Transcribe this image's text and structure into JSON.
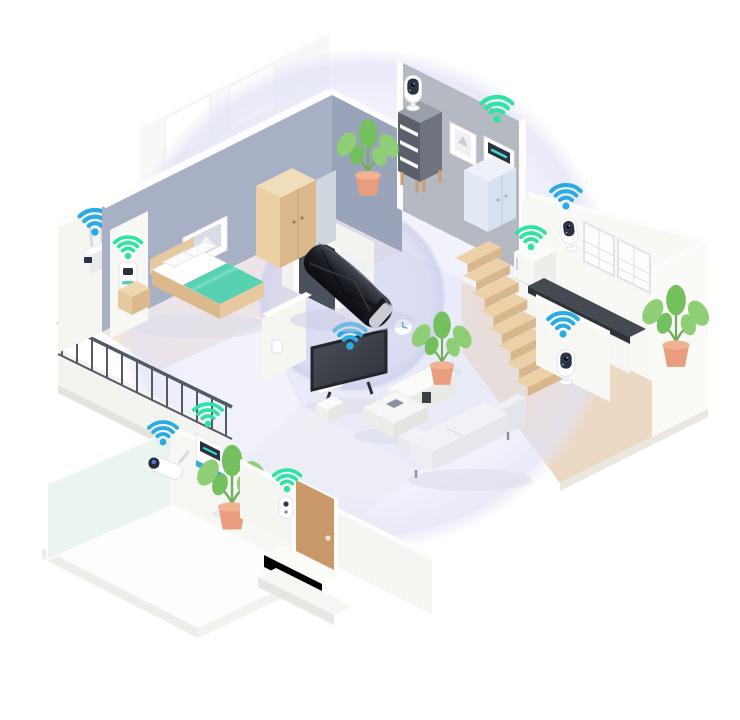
{
  "scene": {
    "type": "isometric-smart-home-wifi-coverage-illustration",
    "description": "Isometric cutaway of a two-level home. A black Wi-Fi router lies at the center of the living room surrounded by two lavender coverage circles. Teal-blue and spring-green Wi-Fi signal icons hover over connected smart devices in every room.",
    "rooms": [
      "bedroom",
      "living room",
      "kitchen",
      "entry hall",
      "balcony",
      "terrace"
    ],
    "coverage": {
      "outer_circle": true,
      "inner_circle": true
    }
  },
  "colors": {
    "bg": "#ffffff",
    "coverageOuter": "#e2e3f6",
    "coverageInner": "#cdd0ee",
    "wifiBlue": "#2aabe3",
    "wifiGreen": "#2fe3a4",
    "wallBlueGray": "#a7b0c4",
    "wallBlueGrayDark": "#99a3b9",
    "wallGray": "#b5b9c1",
    "wallWhite": "#f5f5f2",
    "capWhite": "#fdfdfc",
    "floorBedroom": "#f4e4da",
    "floorLiving": "#f1f2f9",
    "floorKitchen": "#ecd9c4",
    "floorWhite": "#f7f7f6",
    "stairTop": "#ecd0a8",
    "stairFront": "#d9b78c",
    "wood": "#e7c9a0",
    "woodDark": "#dcb98c",
    "teal": "#56d2b2",
    "routerDark": "#17191f",
    "camDark": "#2c3140",
    "doorBrown": "#c9996a",
    "glass": "#e9f4ee",
    "plantGreen": "#8fce77",
    "plantGreenDark": "#74c05f",
    "pot": "#e89e7e",
    "railing": "#525a66",
    "counter": "#454a52",
    "sofa": "#f0f2f5",
    "shadow": "#dcdcea"
  },
  "devices": [
    {
      "id": "router-center",
      "label": "Wi-Fi router (black, center of coverage)",
      "signal": null
    },
    {
      "id": "outdoor-antenna-router",
      "label": "Outdoor antenna access point (left wall)",
      "signal": "blue"
    },
    {
      "id": "plug-in-extender",
      "label": "Plug-in Wi-Fi range extender (bedroom wall)",
      "signal": "green"
    },
    {
      "id": "shelf-camera",
      "label": "Security camera on shelf unit (back wall)",
      "signal": null
    },
    {
      "id": "wall-thermostat",
      "label": "Smart thermostat / alarm panel (back wall)",
      "signal": "green"
    },
    {
      "id": "right-wall-camera",
      "label": "Security camera (kitchen wall corner)",
      "signal": "blue"
    },
    {
      "id": "smart-fridge",
      "label": "Smart appliance at top of stairs",
      "signal": "green"
    },
    {
      "id": "stairs-camera",
      "label": "Security camera on stair half-wall",
      "signal": "blue"
    },
    {
      "id": "smart-tv",
      "label": "Smart TV (living room)",
      "signal": "blue"
    },
    {
      "id": "floor-sensor",
      "label": "Round smart sensor/clock on floor",
      "signal": null
    },
    {
      "id": "outdoor-camera",
      "label": "Outdoor bullet camera (terrace wall)",
      "signal": "blue"
    },
    {
      "id": "smart-panel",
      "label": "Smart control panel (terrace wall)",
      "signal": "green"
    },
    {
      "id": "video-doorbell",
      "label": "Video doorbell (next to front door)",
      "signal": "green"
    }
  ],
  "wifi_icons": {
    "total": 10,
    "blue": [
      "outdoor-antenna-router",
      "right-wall-camera",
      "stairs-camera",
      "smart-tv",
      "outdoor-camera"
    ],
    "green": [
      "plug-in-extender",
      "wall-thermostat",
      "smart-fridge",
      "smart-panel",
      "video-doorbell"
    ]
  },
  "furniture": [
    "bed",
    "nightstand",
    "wardrobe",
    "gray cabinet",
    "shelf unit",
    "light-blue cabinet",
    "TV console",
    "side cube",
    "coffee table",
    "sofa",
    "kitchen counter",
    "stairs (8 steps)",
    "balcony railing",
    "front door",
    "interior door",
    "4 potted plants",
    "2 picture frames",
    "2 windows"
  ]
}
